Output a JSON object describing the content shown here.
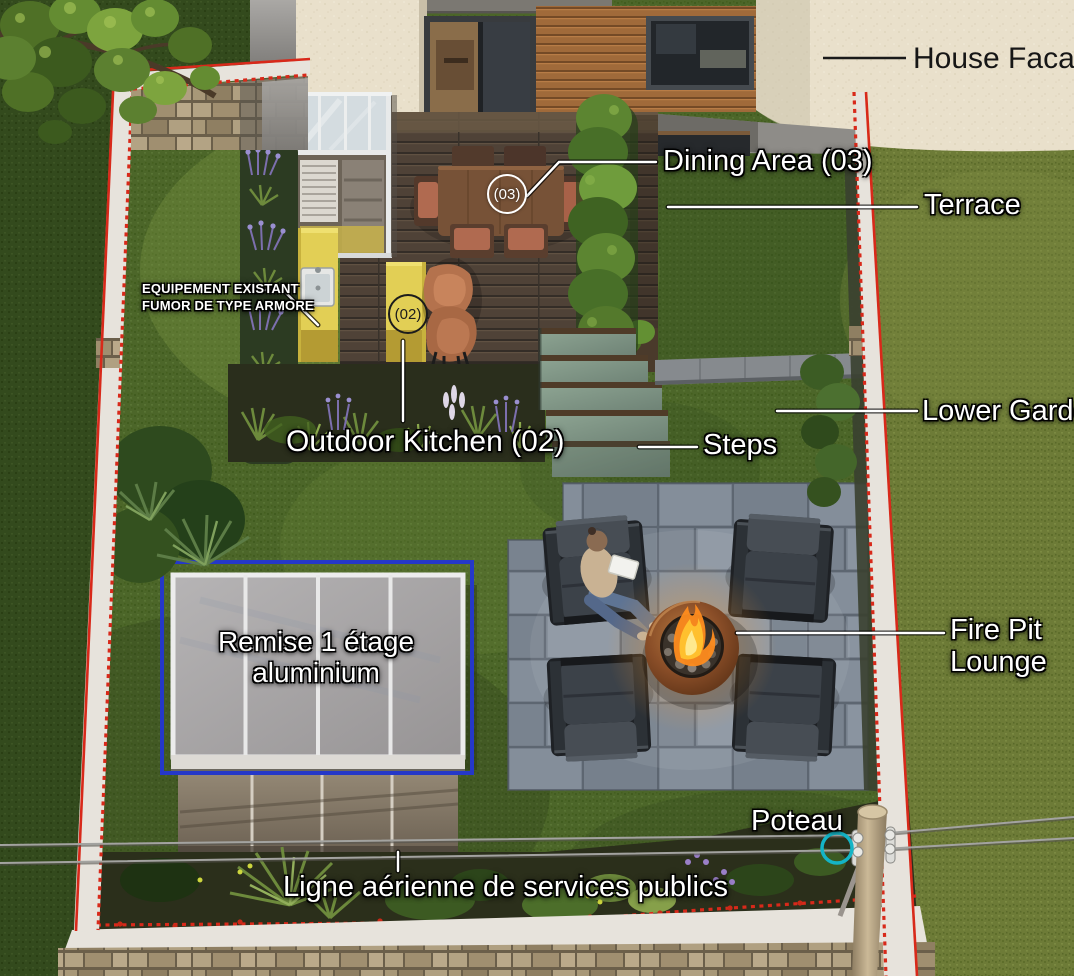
{
  "labels": {
    "house_facade": "House Facade",
    "dining_area": "Dining Area (03)",
    "terrace": "Terrace",
    "lower_garden": "Lower Garden",
    "steps": "Steps",
    "outdoor_kitchen": "Outdoor Kitchen (02)",
    "fire_pit_1": "Fire Pit",
    "fire_pit_2": "Lounge",
    "remise_1": "Remise 1 étage",
    "remise_2": "aluminium",
    "poteau": "Poteau",
    "utility_line": "Ligne aérienne de services publics",
    "equipment_1": "EQUIPEMENT EXISTANT",
    "equipment_2": "FUMOR DE TYPE ARMORE"
  },
  "badges": {
    "dining": "(03)",
    "kitchen": "(02)"
  },
  "colors": {
    "boundary_red": "#d8291a",
    "shed_outline_blue": "#2538c8",
    "pole_circle_teal": "#14b4c6",
    "label_white": "#ffffff",
    "label_dark": "#161616",
    "kitchen_yellow": "#e2cf55",
    "fire_flame_orange": "#ff8c1e",
    "lawn_green": "#4c6629",
    "patio_gray": "#7d8793",
    "deck_brown": "#57493d"
  }
}
